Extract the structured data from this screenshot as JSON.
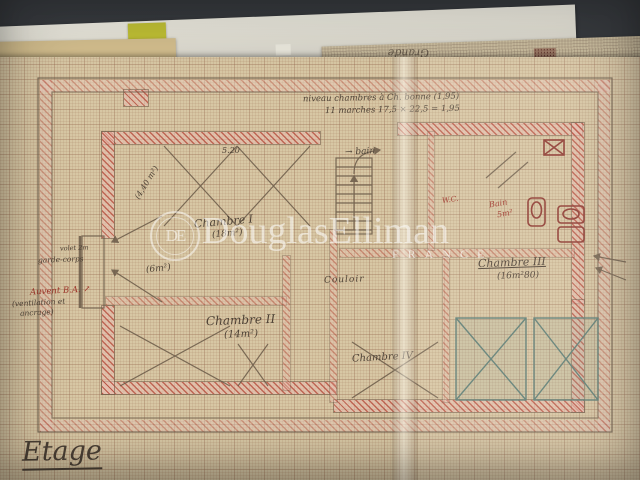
{
  "watermark": {
    "logo_text": "DE",
    "brand": "DouglasElliman",
    "country": "FRANCE"
  },
  "back_sheet": {
    "handwriting": "Grande"
  },
  "plan": {
    "page_title": "Etage",
    "top_note_line1": "niveau chambres à   Ch. bonne (1,95)",
    "top_note_line2": "11 marches   17,5 × 22,5 = 1,95",
    "rooms": [
      {
        "name": "Chambre I",
        "area": "(18m²)"
      },
      {
        "name": "Chambre II",
        "area": "(14m²)"
      },
      {
        "name": "Chambre III",
        "area": "(16m²80)"
      },
      {
        "name": "Chambre IV",
        "area": ""
      },
      {
        "name": "Couloir",
        "area": ""
      }
    ],
    "bath": {
      "wc": "W.C.",
      "bain": "Bain",
      "bain_area": "5m²",
      "arrow_note": "→ bain"
    },
    "dimensions": {
      "ch1_width": "5.20",
      "balcony_area": "(6m²)",
      "diag_note": "(4,40 m²)"
    },
    "left_notes": {
      "volet": "volet 2m",
      "garde_corps": "garde-corps",
      "auvent": "Auvent B.A.",
      "auvent_arrow": "↗",
      "auvent_sub1": "(ventilation et",
      "auvent_sub2": "ancrage)"
    }
  },
  "colors": {
    "red_ink": "#9e352a",
    "pencil": "#6a5a48",
    "wall_hatch": "#c4625a",
    "paper": "#d7c7a4",
    "teal": "#5d7d74"
  }
}
